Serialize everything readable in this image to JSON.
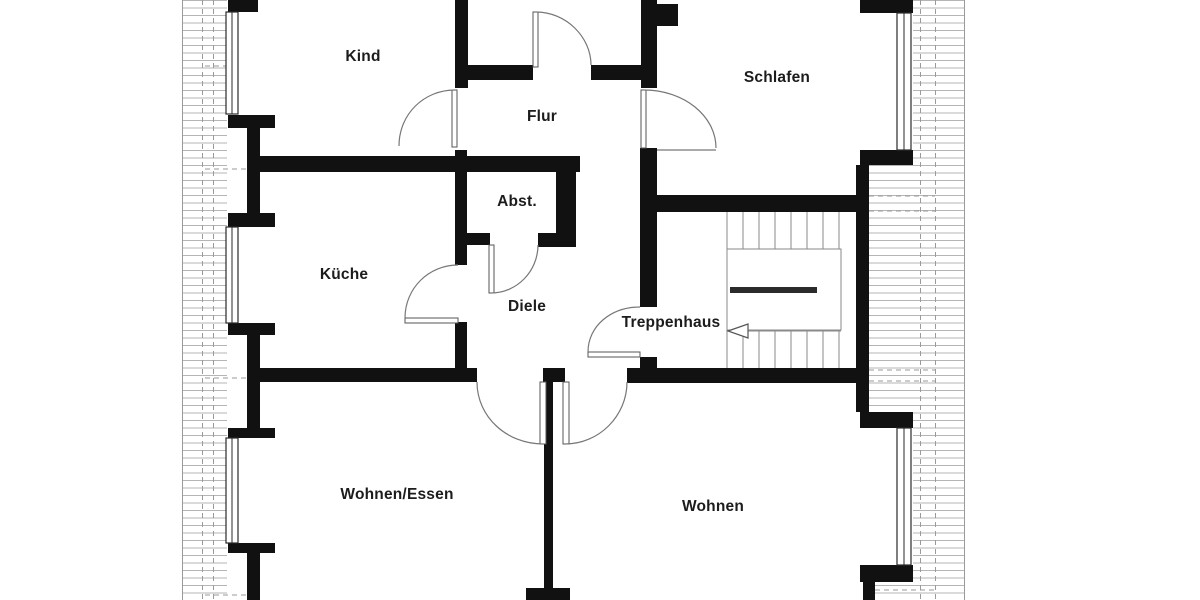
{
  "plan": {
    "type": "floor-plan",
    "language": "de",
    "rooms": [
      {
        "name": "kind",
        "label": "Kind"
      },
      {
        "name": "schlafen",
        "label": "Schlafen"
      },
      {
        "name": "flur",
        "label": "Flur"
      },
      {
        "name": "abstellraum",
        "label": "Abst."
      },
      {
        "name": "kueche",
        "label": "Küche"
      },
      {
        "name": "diele",
        "label": "Diele"
      },
      {
        "name": "treppenhaus",
        "label": "Treppenhaus"
      },
      {
        "name": "wohnen-essen",
        "label": "Wohnen/Essen"
      },
      {
        "name": "wohnen",
        "label": "Wohnen"
      }
    ],
    "colors": {
      "background": "#ffffff",
      "wall": "#111111",
      "door": "#777777",
      "text": "#1c1c1c",
      "hatch": "#b5b5b5"
    }
  }
}
